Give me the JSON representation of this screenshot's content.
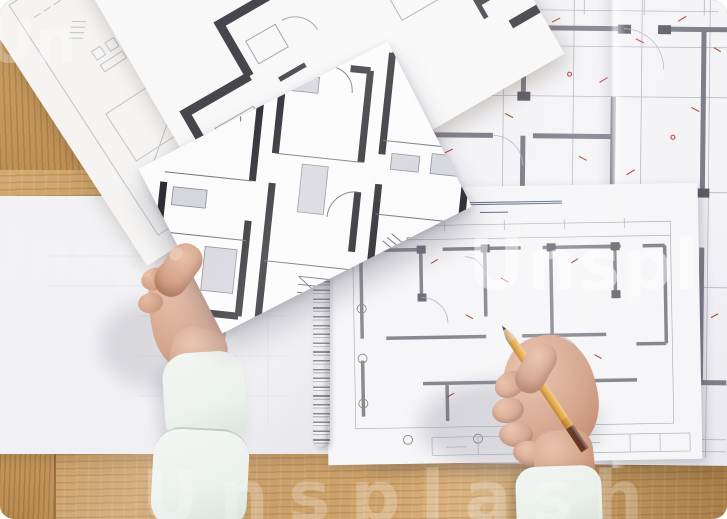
{
  "photo": {
    "alt_text": "Top view of architect hands over a wooden desk covered with architectural floor plan drawings; left hand holds a printed plan, right hand holds a yellow pencil over a spiral-bound plan notebook"
  },
  "watermark": {
    "color": "#ffffff",
    "instances": [
      {
        "text": "Un"
      },
      {
        "text": "Unspl"
      },
      {
        "text": "Unsp"
      },
      {
        "text": "Unsplash"
      }
    ]
  },
  "colors": {
    "wood_base": "#c4975f",
    "wood_shadow": "#a97e49",
    "wood_light": "#d7ad75",
    "wood_seam": "#8a6334",
    "paper": "#f6f6f8",
    "paper_dim": "#ebebee",
    "ink_black": "#2d2d33",
    "wall_gray": "#7e7e88",
    "line_gray": "#b6b6c0",
    "line_sketch": "#9ba0a8",
    "mark_red": "#b5443b",
    "title_blue": "#5b6b85",
    "skin": "#d3a087",
    "skin_shadow": "#ba8168",
    "skin_light": "#e7bda4",
    "sleeve": "#e9efe9",
    "sleeve_shadow": "#d3dfd8",
    "pencil_yellow": "#e6a63c",
    "pencil_yellow_dark": "#d28f28",
    "pencil_wood": "#dbb987",
    "pencil_graphite": "#3f3f44",
    "pencil_end": "#5e2d24",
    "watermark": "#ffffff"
  }
}
